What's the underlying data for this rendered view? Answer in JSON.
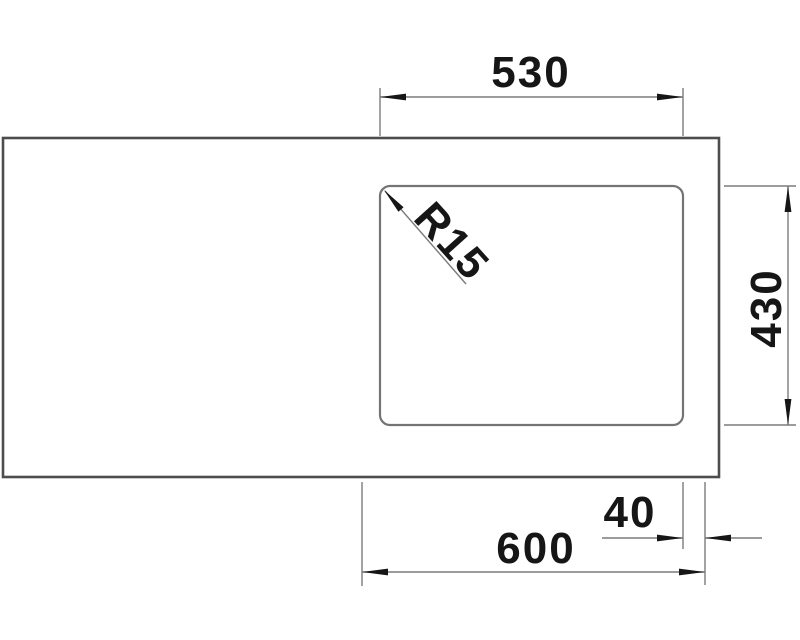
{
  "drawing": {
    "type": "technical-dimension-drawing",
    "view": "sink-top-view",
    "dimensions": {
      "bowl_width": "530",
      "bowl_depth": "430",
      "corner_radius": "R15",
      "overall_width": "600",
      "right_offset": "40"
    },
    "colors": {
      "background": "#ffffff",
      "outer_outline": "#4d4d4d",
      "bowl_outline": "#747474",
      "dimension_lines": "#7c7c7c",
      "text_and_arrows": "#161616"
    }
  }
}
